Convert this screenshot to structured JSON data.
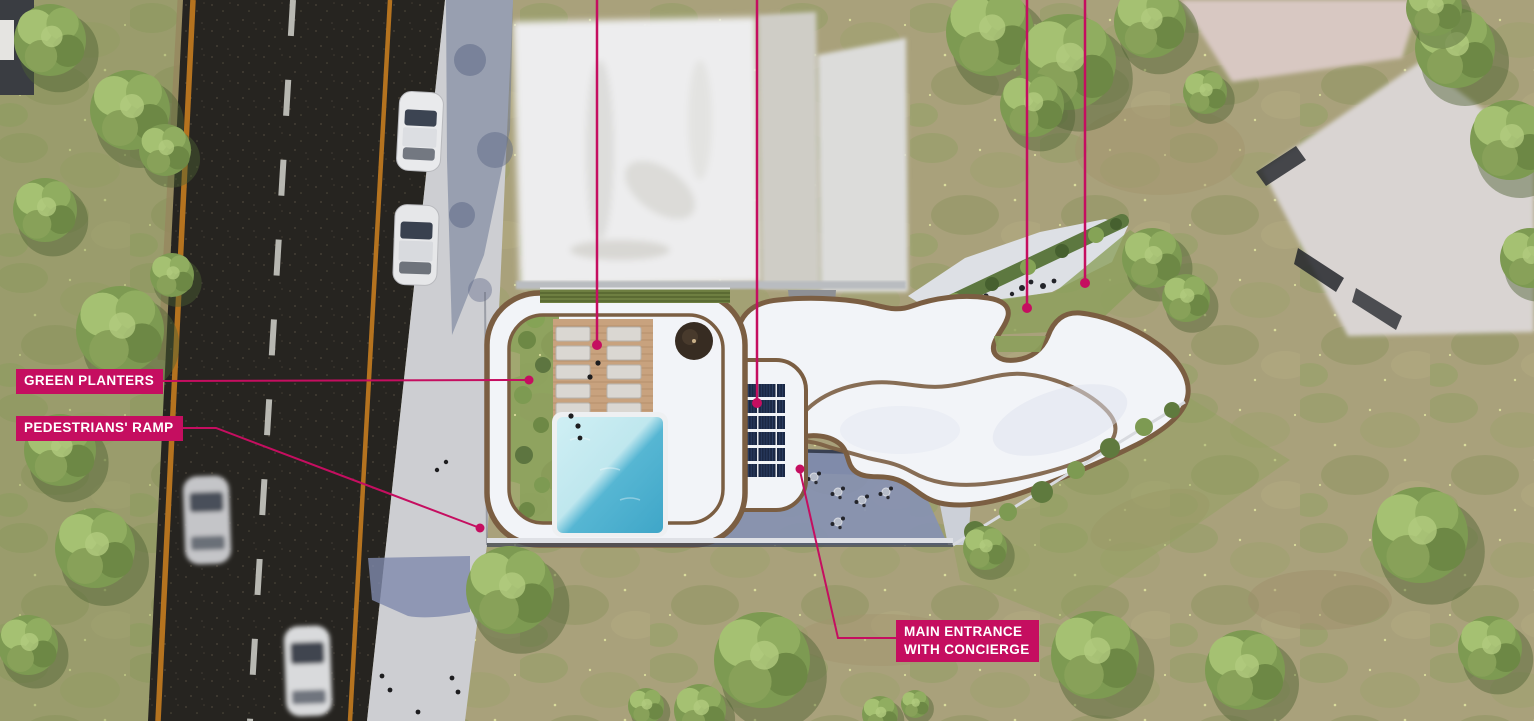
{
  "annotations": {
    "labels": [
      {
        "id": "green-planters",
        "lines": [
          "GREEN PLANTERS"
        ]
      },
      {
        "id": "pedestrians-ramp",
        "lines": [
          "PEDESTRIANS' RAMP"
        ]
      },
      {
        "id": "main-entrance-with-concierge",
        "lines": [
          "MAIN ENTRANCE",
          "WITH CONCIERGE"
        ]
      }
    ],
    "unlabeled_leader_lines_cropped_at_top": 4
  },
  "colors": {
    "accent": "#c50e60",
    "label_text": "#ffffff",
    "grass_base": "#a9a17b",
    "grass_green": "#8f9e60",
    "tree_green": "#7d9a52",
    "tree_light": "#a5c172",
    "road_asphalt": "#262420",
    "road_line_orange": "#b5731f",
    "road_dash_white": "#d2d2cc",
    "sidewalk": "#cdced2",
    "shadow_blue": "#8791b2",
    "roof_white": "#f2f4f8",
    "wood_trim_brown": "#7b5e42",
    "deck_wood": "#c8a27e",
    "pool_light": "#c9ecf1",
    "pool_dark": "#3fa6c8",
    "solar_panel_navy": "#1b2845",
    "hedge_green": "#6e7f41",
    "neighbor_roof_white": "#ececec"
  },
  "scene": {
    "type": "architectural-aerial-site-plan-rendering",
    "features": [
      "two-lane-road",
      "parked-cars",
      "moving-cars",
      "sidewalk",
      "residential-building-organic-roof",
      "courtyard-garden",
      "swimming-pool",
      "sun-deck",
      "sun-loungers",
      "pool-umbrella",
      "solar-panel-array",
      "green-planters-hedge",
      "entrance-plaza-in-shadow",
      "roof-terrace-with-tables",
      "neighbor-buildings-blurred",
      "grass-field",
      "trees"
    ],
    "counts": {
      "sun_loungers": 10,
      "cars": 4,
      "solar_panel_rows": 6,
      "solar_panel_columns": 7,
      "labeled_annotations": 3,
      "cropped_leader_lines": 4
    }
  }
}
